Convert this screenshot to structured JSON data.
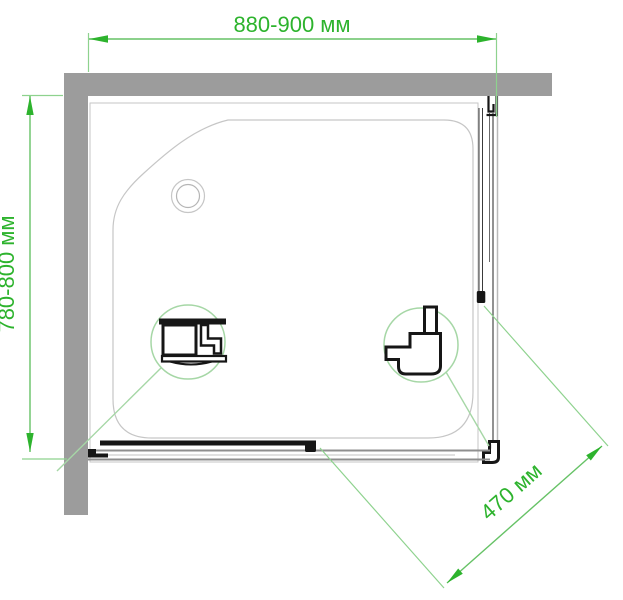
{
  "diagram": {
    "kind": "shower-enclosure-top-view-installation-drawing",
    "dimensions": {
      "top_width": "880-900 мм",
      "left_depth": "780-800 мм",
      "diagonal_door": "470 мм"
    },
    "colors": {
      "dimension_text_green": "#2db32d",
      "dimension_arrow_green": "#2db32d",
      "dimension_line_green": "#66c266",
      "extension_line_green": "#8ed28e",
      "callout_circle_green": "#a6d7a6",
      "wall_gray": "#9c9c9c",
      "tray_outline_gray": "#c6c6c6",
      "rail_gray": "#8f8f8f",
      "profile_black": "#161616"
    },
    "icons": {
      "left_callout": "wall-profile-cross-section-icon",
      "right_callout": "corner-profile-cross-section-icon",
      "drain": "drain-icon"
    }
  }
}
